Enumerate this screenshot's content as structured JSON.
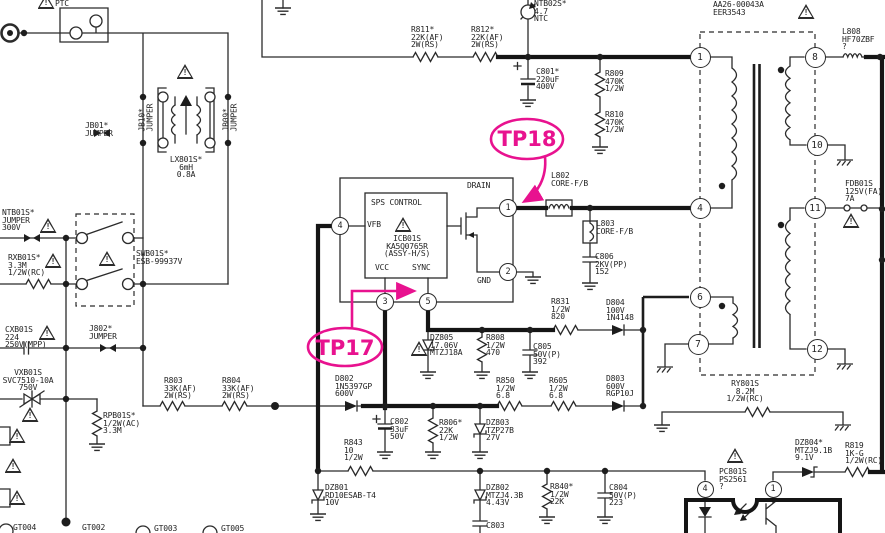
{
  "meta": {
    "kind": "smps-circuit-schematic",
    "description": "Switch-mode power supply schematic section with SPS control IC, mains filter and flyback transformer"
  },
  "colors": {
    "background": "#ffffff",
    "line": "#2b2b2b",
    "thick_line": "#151515",
    "annotation_pink": "#e8128f"
  },
  "diagram": {
    "icons": {
      "warning_glyph": "!"
    },
    "test_points": {
      "tp17": {
        "label": "TP17"
      },
      "tp18": {
        "label": "TP18"
      }
    },
    "labels": [
      {
        "name": "ptc",
        "x": 55,
        "y": 0,
        "lines": [
          "PTC"
        ]
      },
      {
        "name": "jb01",
        "x": 85,
        "y": 122,
        "lines": [
          "JB01*",
          "JUMPER"
        ]
      },
      {
        "name": "jb10",
        "x": 132,
        "y": 110,
        "rotate": -90,
        "lines": [
          "JB10*",
          "JUMPER"
        ]
      },
      {
        "name": "jb09",
        "x": 216,
        "y": 110,
        "rotate": -90,
        "lines": [
          "JB09*",
          "JUMPER"
        ]
      },
      {
        "name": "lx801",
        "x": 160,
        "y": 156,
        "w": 52,
        "lines": [
          "LX801S*",
          "6mH",
          "0.8A"
        ]
      },
      {
        "name": "ntb01",
        "x": 2,
        "y": 209,
        "lines": [
          "NTB01S*",
          "JUMPER",
          "300V"
        ]
      },
      {
        "name": "swb01",
        "x": 136,
        "y": 250,
        "lines": [
          "SWB01S*",
          "ESB-99937V"
        ]
      },
      {
        "name": "rxb01",
        "x": 8,
        "y": 254,
        "lines": [
          "RXB01S*",
          "3.3M",
          "1/2W(RC)"
        ]
      },
      {
        "name": "cxb01",
        "x": 5,
        "y": 326,
        "lines": [
          "CXB01S",
          "224",
          "250V(MPP)"
        ]
      },
      {
        "name": "j802",
        "x": 89,
        "y": 325,
        "lines": [
          "J802*",
          "JUMPER"
        ]
      },
      {
        "name": "vxb01",
        "x": 0,
        "y": 369,
        "w": 56,
        "lines": [
          "VXB01S",
          "SVC7510-10A",
          "750V"
        ]
      },
      {
        "name": "rpb01",
        "x": 103,
        "y": 412,
        "lines": [
          "RPB01S*",
          "1/2W(AC)",
          "3.3M"
        ]
      },
      {
        "name": "r803",
        "x": 164,
        "y": 377,
        "lines": [
          "R803",
          "33K(AF)",
          "2W(RS)"
        ]
      },
      {
        "name": "r804",
        "x": 222,
        "y": 377,
        "lines": [
          "R804",
          "33K(AF)",
          "2W(RS)"
        ]
      },
      {
        "name": "r811",
        "x": 411,
        "y": 26,
        "lines": [
          "R811*",
          "22K(AF)",
          "2W(RS)"
        ]
      },
      {
        "name": "r812",
        "x": 471,
        "y": 26,
        "lines": [
          "R812*",
          "22K(AF)",
          "2W(RS)"
        ]
      },
      {
        "name": "ntb02",
        "x": 534,
        "y": 0,
        "lines": [
          "NTB02S*",
          "4.7",
          "NTC"
        ]
      },
      {
        "name": "c801",
        "x": 536,
        "y": 68,
        "lines": [
          "C801*",
          "220uF",
          "400V"
        ]
      },
      {
        "name": "r809",
        "x": 605,
        "y": 70,
        "lines": [
          "R809",
          "470K",
          "1/2W"
        ]
      },
      {
        "name": "r810",
        "x": 605,
        "y": 111,
        "lines": [
          "R810",
          "470K",
          "1/2W"
        ]
      },
      {
        "name": "t801-ref",
        "x": 728,
        "y": -6,
        "lines": [
          "T801S*"
        ]
      },
      {
        "name": "t801",
        "x": 713,
        "y": 1,
        "lines": [
          "AA26-00043A",
          "EER3543"
        ]
      },
      {
        "name": "l808",
        "x": 842,
        "y": 28,
        "lines": [
          "L808",
          "HF70ZBF",
          "?"
        ]
      },
      {
        "name": "fdb01",
        "x": 845,
        "y": 180,
        "lines": [
          "FDB01S",
          "125V(FA)",
          "7A"
        ]
      },
      {
        "name": "l802",
        "x": 551,
        "y": 172,
        "lines": [
          "L802",
          "CORE-F/B"
        ]
      },
      {
        "name": "l803",
        "x": 596,
        "y": 220,
        "lines": [
          "L803",
          "CORE-F/B"
        ]
      },
      {
        "name": "c806",
        "x": 595,
        "y": 253,
        "lines": [
          "C806",
          "2KV(PP)",
          "152"
        ]
      },
      {
        "name": "sps-control",
        "x": 371,
        "y": 199,
        "lines": [
          "SPS CONTROL"
        ]
      },
      {
        "name": "vfb",
        "x": 367,
        "y": 221,
        "lines": [
          "VFB"
        ]
      },
      {
        "name": "vcc",
        "x": 375,
        "y": 264,
        "lines": [
          "VCC"
        ]
      },
      {
        "name": "sync",
        "x": 412,
        "y": 264,
        "lines": [
          "SYNC"
        ]
      },
      {
        "name": "icb01",
        "x": 370,
        "y": 235,
        "w": 74,
        "lines": [
          "ICB01S",
          "KA5Q0765R",
          "(ASSY-H/S)"
        ]
      },
      {
        "name": "drain",
        "x": 467,
        "y": 182,
        "lines": [
          "DRAIN"
        ]
      },
      {
        "name": "gnd-pin",
        "x": 477,
        "y": 277,
        "lines": [
          "GND"
        ]
      },
      {
        "name": "r831",
        "x": 551,
        "y": 298,
        "lines": [
          "R831",
          "1/2W",
          "820"
        ]
      },
      {
        "name": "d804",
        "x": 606,
        "y": 299,
        "lines": [
          "D804",
          "100V",
          "1N4148"
        ]
      },
      {
        "name": "dz805",
        "x": 430,
        "y": 334,
        "lines": [
          "DZ805",
          "17.06V",
          "MTZJ18A"
        ]
      },
      {
        "name": "r808",
        "x": 486,
        "y": 334,
        "lines": [
          "R808",
          "1/2W",
          "470"
        ]
      },
      {
        "name": "c805",
        "x": 533,
        "y": 343,
        "lines": [
          "C805",
          "50V(P)",
          "392"
        ]
      },
      {
        "name": "r850",
        "x": 496,
        "y": 377,
        "lines": [
          "R850",
          "1/2W",
          "6.8"
        ]
      },
      {
        "name": "r605",
        "x": 549,
        "y": 377,
        "lines": [
          "R605",
          "1/2W",
          "6.8"
        ]
      },
      {
        "name": "d803",
        "x": 606,
        "y": 375,
        "lines": [
          "D803",
          "600V",
          "RGP10J"
        ]
      },
      {
        "name": "d802",
        "x": 335,
        "y": 375,
        "lines": [
          "D802",
          "1N5397GP",
          "600V"
        ]
      },
      {
        "name": "c802",
        "x": 390,
        "y": 418,
        "lines": [
          "C802",
          "33uF",
          "50V"
        ]
      },
      {
        "name": "r806",
        "x": 439,
        "y": 419,
        "lines": [
          "R806*",
          "22K",
          "1/2W"
        ]
      },
      {
        "name": "dz803",
        "x": 486,
        "y": 419,
        "lines": [
          "DZ803",
          "TZP27B",
          "27V"
        ]
      },
      {
        "name": "r843",
        "x": 344,
        "y": 439,
        "lines": [
          "R843",
          "10",
          "1/2W"
        ]
      },
      {
        "name": "dz801",
        "x": 325,
        "y": 484,
        "lines": [
          "DZ801",
          "RD10ESAB-T4",
          "10V"
        ]
      },
      {
        "name": "dz802",
        "x": 486,
        "y": 484,
        "lines": [
          "DZ802",
          "MTZJ4.3B",
          "4.43V"
        ]
      },
      {
        "name": "c803",
        "x": 486,
        "y": 522,
        "lines": [
          "C803"
        ]
      },
      {
        "name": "r840",
        "x": 550,
        "y": 483,
        "lines": [
          "R840*",
          "1/2W",
          "22K"
        ]
      },
      {
        "name": "c804",
        "x": 609,
        "y": 484,
        "lines": [
          "C804",
          "50V(P)",
          "223"
        ]
      },
      {
        "name": "ry801",
        "x": 715,
        "y": 380,
        "w": 60,
        "lines": [
          "RY801S",
          "8.2M",
          "1/2W(RC)"
        ]
      },
      {
        "name": "pc801",
        "x": 719,
        "y": 468,
        "lines": [
          "PC801S",
          "PS2561",
          "?"
        ]
      },
      {
        "name": "dz804",
        "x": 795,
        "y": 439,
        "lines": [
          "DZ804*",
          "MTZJ9.1B",
          "9.1V"
        ]
      },
      {
        "name": "r819",
        "x": 845,
        "y": 442,
        "lines": [
          "R819",
          "1K-G",
          "1/2W(RC)"
        ]
      },
      {
        "name": "gt004",
        "x": 13,
        "y": 524,
        "lines": [
          "GT004"
        ]
      },
      {
        "name": "gt002",
        "x": 82,
        "y": 524,
        "lines": [
          "GT002"
        ]
      },
      {
        "name": "gt003",
        "x": 154,
        "y": 525,
        "lines": [
          "GT003"
        ]
      },
      {
        "name": "gt005",
        "x": 221,
        "y": 525,
        "lines": [
          "GT005"
        ]
      }
    ],
    "pins": [
      {
        "n": "4",
        "x": 340,
        "y": 226,
        "d": 18
      },
      {
        "n": "3",
        "x": 385,
        "y": 302,
        "d": 18
      },
      {
        "n": "5",
        "x": 428,
        "y": 302,
        "d": 18
      },
      {
        "n": "1",
        "x": 508,
        "y": 208,
        "d": 18
      },
      {
        "n": "2",
        "x": 508,
        "y": 272,
        "d": 18
      },
      {
        "n": "1",
        "x": 700,
        "y": 57,
        "d": 21
      },
      {
        "n": "4",
        "x": 700,
        "y": 208,
        "d": 21
      },
      {
        "n": "6",
        "x": 700,
        "y": 297,
        "d": 21
      },
      {
        "n": "7",
        "x": 698,
        "y": 344,
        "d": 21
      },
      {
        "n": "8",
        "x": 815,
        "y": 57,
        "d": 21
      },
      {
        "n": "10",
        "x": 817,
        "y": 145,
        "d": 21
      },
      {
        "n": "11",
        "x": 815,
        "y": 208,
        "d": 21
      },
      {
        "n": "12",
        "x": 817,
        "y": 349,
        "d": 21
      },
      {
        "n": "4",
        "x": 705,
        "y": 489,
        "d": 17
      },
      {
        "n": "1",
        "x": 773,
        "y": 489,
        "d": 17
      }
    ],
    "warnings": [
      {
        "x": 46,
        "y": -6
      },
      {
        "x": 185,
        "y": 64
      },
      {
        "x": 48,
        "y": 218
      },
      {
        "x": 107,
        "y": 251
      },
      {
        "x": 53,
        "y": 253
      },
      {
        "x": 47,
        "y": 325
      },
      {
        "x": 30,
        "y": 407
      },
      {
        "x": 806,
        "y": 4
      },
      {
        "x": 851,
        "y": 213
      },
      {
        "x": 403,
        "y": 217
      },
      {
        "x": 419,
        "y": 341
      },
      {
        "x": 735,
        "y": 448
      },
      {
        "x": 17,
        "y": 428
      },
      {
        "x": 13,
        "y": 458
      },
      {
        "x": 17,
        "y": 490
      }
    ]
  }
}
